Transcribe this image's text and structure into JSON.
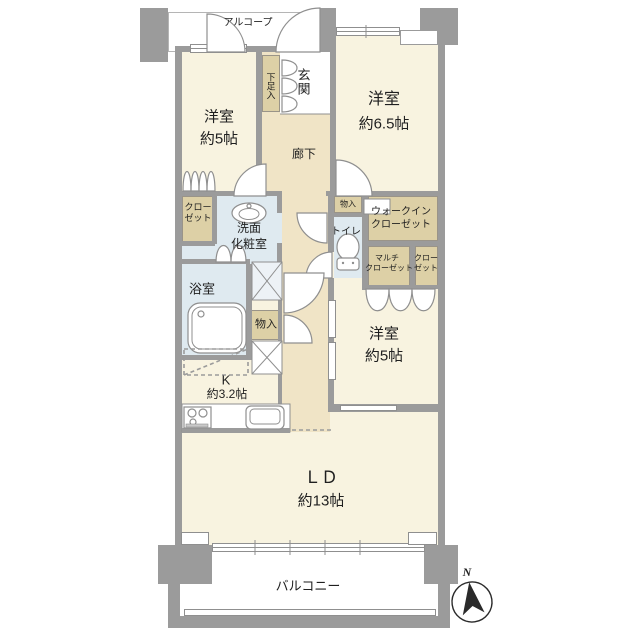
{
  "rooms": {
    "alcove": {
      "label": "アルコープ"
    },
    "entrance": {
      "label": "玄関"
    },
    "shoe_box": {
      "label": "下足入"
    },
    "hallway": {
      "label": "廊下"
    },
    "bedroom_top_left": {
      "name": "洋室",
      "size": "約5帖"
    },
    "bedroom_top_right": {
      "name": "洋室",
      "size": "約6.5帖"
    },
    "closet_left": {
      "line1": "クロー",
      "line2": "ゼット"
    },
    "washroom": {
      "line1": "洗面",
      "line2": "化粧室"
    },
    "bathroom": {
      "label": "浴室"
    },
    "storage_hall": {
      "label": "物入"
    },
    "storage_toilet": {
      "label": "物入"
    },
    "toilet": {
      "label": "トイレ"
    },
    "walk_in_closet": {
      "line1": "ウォークイン",
      "line2": "クローゼット"
    },
    "multi_closet": {
      "line1": "マルチ",
      "line2": "クローゼット"
    },
    "closet_right": {
      "line1": "クロー",
      "line2": "ゼット"
    },
    "bedroom_middle_right": {
      "name": "洋室",
      "size": "約5帖"
    },
    "kitchen": {
      "name": "K",
      "size": "約3.2帖"
    },
    "living_dining": {
      "name": "ＬＤ",
      "size": "約13帖"
    },
    "balcony": {
      "label": "バルコニー"
    }
  },
  "compass": {
    "north_label": "N"
  },
  "colors": {
    "wall": "#9b9b9b",
    "room_cream": "#f8f3e0",
    "hall_beige": "#f0e4c6",
    "closet_beige": "#ddd0a6",
    "wet_blue": "#dfeaf0",
    "outline": "#8f8f8f",
    "text": "#1f1f1f"
  }
}
